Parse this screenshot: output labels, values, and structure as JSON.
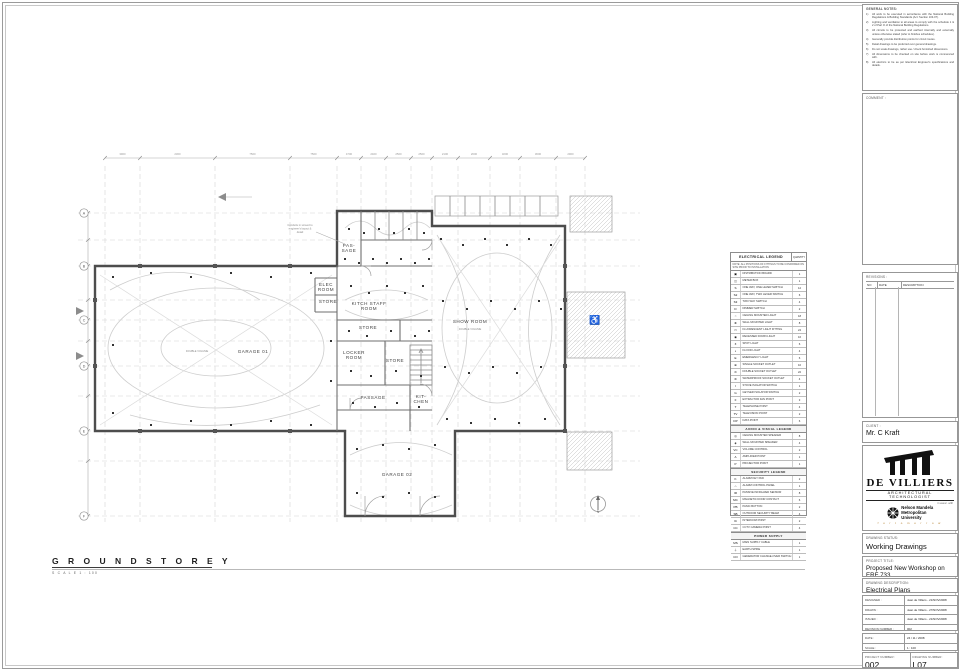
{
  "plan_title": {
    "label": "G R O U N D   S T O R E Y",
    "scale": "S C A L E   1 : 100"
  },
  "plan": {
    "north": "N",
    "note_lines": [
      "Conduits in screed to",
      "engineer's layout &",
      "detail"
    ],
    "grid_xs": [
      105,
      140,
      215,
      290,
      337,
      361,
      386,
      411,
      432,
      458,
      490,
      520,
      556,
      585
    ],
    "grid_ys": [
      213,
      240,
      266,
      300,
      320,
      341,
      366,
      396,
      431,
      461,
      516
    ],
    "dims_top": [
      "3900",
      "2300",
      "7500",
      "7500",
      "4700",
      "2400",
      "2500",
      "2500",
      "2100",
      "2600",
      "3200",
      "3600",
      "2900"
    ],
    "grid_left": [
      {
        "l": "A",
        "y": 213
      },
      {
        "l": "B",
        "y": 266
      },
      {
        "l": "C",
        "y": 320
      },
      {
        "l": "D",
        "y": 366
      },
      {
        "l": "E",
        "y": 431
      },
      {
        "l": "F",
        "y": 516
      }
    ],
    "rooms": [
      {
        "id": "passage-upper",
        "label": "PAS-|SAGE",
        "x": 349,
        "y": 247
      },
      {
        "id": "elec-room",
        "label": "ELEC|ROOM",
        "x": 326,
        "y": 286
      },
      {
        "id": "store-1",
        "label": "STORE",
        "x": 328,
        "y": 303
      },
      {
        "id": "kitch-staff-room",
        "label": "KITCH STAFF|ROOM",
        "x": 369,
        "y": 305
      },
      {
        "id": "store-2",
        "label": "STORE",
        "x": 368,
        "y": 329
      },
      {
        "id": "locker-room",
        "label": "LOCKER|ROOM",
        "x": 354,
        "y": 354
      },
      {
        "id": "store-3",
        "label": "STORE",
        "x": 395,
        "y": 362
      },
      {
        "id": "passage",
        "label": "PASSAGE",
        "x": 373,
        "y": 399
      },
      {
        "id": "kitchen",
        "label": "KIT-|CHEN",
        "x": 421,
        "y": 398
      },
      {
        "id": "show-room",
        "label": "SHOW ROOM",
        "x": 470,
        "y": 323,
        "sub": "DOUBLE VOLUME",
        "sub_x": 470,
        "sub_y": 330
      },
      {
        "id": "garage-01",
        "label": "GARAGE 01",
        "x": 253,
        "y": 353,
        "sub": "DOUBLE VOLUME",
        "sub_x": 197,
        "sub_y": 352
      },
      {
        "id": "garage-02",
        "label": "GARAGE 02",
        "x": 397,
        "y": 476
      }
    ]
  },
  "legend": {
    "title": "ELECTRICAL LEGEND",
    "qty_header": "QUANTITY",
    "note": "NOTE: ALL POSITIONS OF FITTINGS TO BE CONFIRMED ON SITE PRIOR TO INSTALLATION",
    "sections": [
      {
        "header": null,
        "rows": [
          {
            "s": "▣",
            "l": "DISTRIBUTION BOARD",
            "q": "1"
          },
          {
            "s": "◫",
            "l": "METER BOX",
            "q": "1"
          },
          {
            "s": "S",
            "l": "ONE WAY, ONE LEVER SWITCH",
            "q": "12"
          },
          {
            "s": "S2",
            "l": "ONE WAY, TWO LEVER SWITCH",
            "q": "6"
          },
          {
            "s": "S3",
            "l": "TWO WAY SWITCH",
            "q": "4"
          },
          {
            "s": "D",
            "l": "DIMMER SWITCH",
            "q": "2"
          },
          {
            "s": "○",
            "l": "CEILING MOUNTED LIGHT",
            "q": "18"
          },
          {
            "s": "⊗",
            "l": "WALL MOUNTED LIGHT",
            "q": "8"
          },
          {
            "s": "▭",
            "l": "FLUORESCENT LIGHT FITTING",
            "q": "24"
          },
          {
            "s": "◉",
            "l": "RECESSED DOWN LIGHT",
            "q": "16"
          },
          {
            "s": "✶",
            "l": "SPOT LIGHT",
            "q": "6"
          },
          {
            "s": "◐",
            "l": "FLOOD LIGHT",
            "q": "4"
          },
          {
            "s": "E",
            "l": "EMERGENCY LIGHT",
            "q": "6"
          },
          {
            "s": "⊕",
            "l": "SINGLE SOCKET OUTLET",
            "q": "10"
          },
          {
            "s": "⊜",
            "l": "DOUBLE SOCKET OUTLET",
            "q": "22"
          },
          {
            "s": "⊛",
            "l": "WATERPROOF SOCKET OUTLET",
            "q": "4"
          },
          {
            "s": "I",
            "l": "STOVE ISOLATOR SWITCH",
            "q": "1"
          },
          {
            "s": "G",
            "l": "GEYSER ISOLATOR SWITCH",
            "q": "2"
          },
          {
            "s": "F",
            "l": "EXTRACTOR FAN POINT",
            "q": "3"
          },
          {
            "s": "T",
            "l": "TELEPHONE POINT",
            "q": "4"
          },
          {
            "s": "TV",
            "l": "TELEVISION POINT",
            "q": "2"
          },
          {
            "s": "DP",
            "l": "DATA POINT",
            "q": "6"
          }
        ]
      },
      {
        "header": "AUDIO & VISUAL LEGEND",
        "rows": [
          {
            "s": "◎",
            "l": "CEILING MOUNTED SPEAKER",
            "q": "8"
          },
          {
            "s": "◈",
            "l": "WALL MOUNTED SPEAKER",
            "q": "4"
          },
          {
            "s": "VC",
            "l": "VOLUME CONTROL",
            "q": "2"
          },
          {
            "s": "A",
            "l": "AMPLIFIER POINT",
            "q": "1"
          },
          {
            "s": "P",
            "l": "PROJECTOR POINT",
            "q": "1"
          }
        ]
      },
      {
        "header": "SECURITY LEGEND",
        "rows": [
          {
            "s": "K",
            "l": "ALARM KEY PAD",
            "q": "2"
          },
          {
            "s": "⌂",
            "l": "ALARM CONTROL PANEL",
            "q": "1"
          },
          {
            "s": "IR",
            "l": "PASSIVE INFRA-RED SENSOR",
            "q": "8"
          },
          {
            "s": "MC",
            "l": "MAGNETIC DOOR CONTACT",
            "q": "6"
          },
          {
            "s": "PB",
            "l": "PANIC BUTTON",
            "q": "2"
          },
          {
            "s": "SB",
            "l": "OUTDOOR SECURITY BEAM",
            "q": "4"
          },
          {
            "s": "IC",
            "l": "INTERCOM POINT",
            "q": "2"
          },
          {
            "s": "CC",
            "l": "CCTV CAMERA POINT",
            "q": "4"
          }
        ]
      },
      {
        "header": "POWER SUPPLY",
        "rows": [
          {
            "s": "MS",
            "l": "MAIN SUPPLY CABLE",
            "q": "1"
          },
          {
            "s": "⏚",
            "l": "EARTH SPIKE",
            "q": "1"
          },
          {
            "s": "CO",
            "l": "GENERATOR CHANGE-OVER SWITCH",
            "q": "1"
          }
        ]
      }
    ]
  },
  "notes_panel": {
    "title": "GENERAL NOTES:",
    "items": [
      "All work to be executed in accordance with the National Building Regulations & Building Standards (Act: Section 103-07).",
      "Lighting and ventilation to all areas to comply with the schedule 1 & 2 of Part O of the National Building Regulations.",
      "All circuits to be protected and earthed internally and externally unless otherwise stated (refer to finishes schedules).",
      "Generally provide distribution points for circuit routes.",
      "Detail drawings to be preferred over general drawings.",
      "Do not scale drawings, rather use / check furnished dimensions.",
      "All dimensions to be checked on site before work is commenced with.",
      "All electrics to be as per Electrical Engineer's specifications and details."
    ]
  },
  "comment_panel": {
    "title": "COMMENT :"
  },
  "revisions": {
    "title": "REVISIONS :",
    "columns": [
      "NO",
      "DATE",
      "DESCRIPTION"
    ]
  },
  "client": {
    "label": "CLIENT :",
    "name": "Mr. C Kraft"
  },
  "firm": {
    "name": "DE VILLIERS",
    "subtitle": "ARCHITECTURAL TECHNOLOGIST",
    "assoc": "in assoc. with",
    "partner_line1": "Nelson Mandela",
    "partner_line2": "Metropolitan",
    "partner_line3": "University",
    "tagline": "f o r   t o m o r r o w"
  },
  "status_panel": {
    "label": "DRAWING STATUS:",
    "value": "Working Drawings"
  },
  "project_panel": {
    "label": "PROJECT TITLE:",
    "value": "Proposed New Workshop on ERF 733"
  },
  "description_panel": {
    "label": "DRAWING DESCRIPTION:",
    "value": "Electrical Plans"
  },
  "signoff": {
    "rows": [
      {
        "label": "DESIGNED :",
        "value": "Jean de Villiers - 21/NOV/2008"
      },
      {
        "label": "DRAWN :",
        "value": "Jean de Villiers - 27/NOV/2008"
      },
      {
        "label": "ISSUED :",
        "value": "Jean de Villiers - 21/NOV/2008"
      },
      {
        "label": "REVISION NUMBER :",
        "value": "002"
      }
    ],
    "date_label": "DATE :",
    "date": "24 / 11 / 2008",
    "scale_label": "SCALE :",
    "scale": "1 : 100",
    "project_number_label": "PROJECT NUMBER:",
    "project_number": "002",
    "drawing_number_label": "DRAWING NUMBER:",
    "drawing_number": "L07"
  }
}
